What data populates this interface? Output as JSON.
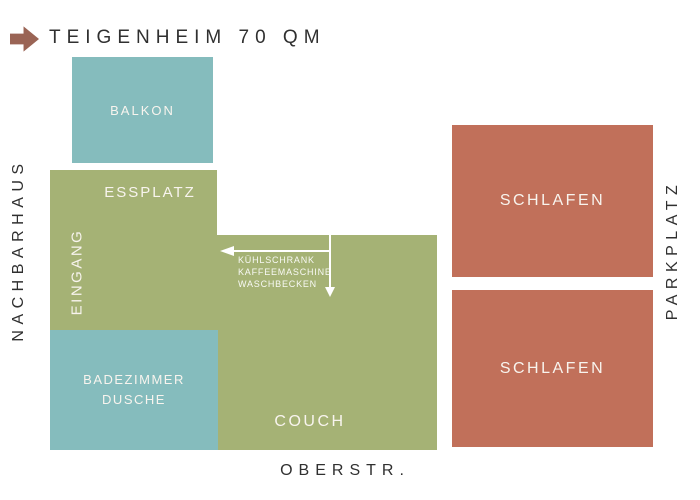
{
  "title": {
    "text": "TEIGENHEIM 70 QM"
  },
  "colors": {
    "teal": "#85bcbd",
    "olive_green": "#a5b275",
    "rust": "#c1705a",
    "arrow_brown": "#9a6455",
    "ink": "#303030",
    "room_label_white": "#f8f4ee"
  },
  "rooms": {
    "balkon": {
      "label": "BALKON"
    },
    "essplatz": {
      "label": "ESSPLATZ"
    },
    "eingang": {
      "label": "EINGANG"
    },
    "badezimmer": {
      "label_line1": "BADEZIMMER",
      "label_line2": "DUSCHE"
    },
    "couch": {
      "label": "COUCH"
    },
    "schlafen_top": {
      "label": "SCHLAFEN"
    },
    "schlafen_bottom": {
      "label": "SCHLAFEN"
    }
  },
  "kitchen_annotation": {
    "lines": [
      "KÜHLSCHRANK",
      "KAFFEEMASCHINE",
      "WASCHBECKEN"
    ]
  },
  "surroundings": {
    "left": "NACHBARHAUS",
    "right": "PARKPLATZ",
    "bottom": "OBERSTR."
  }
}
